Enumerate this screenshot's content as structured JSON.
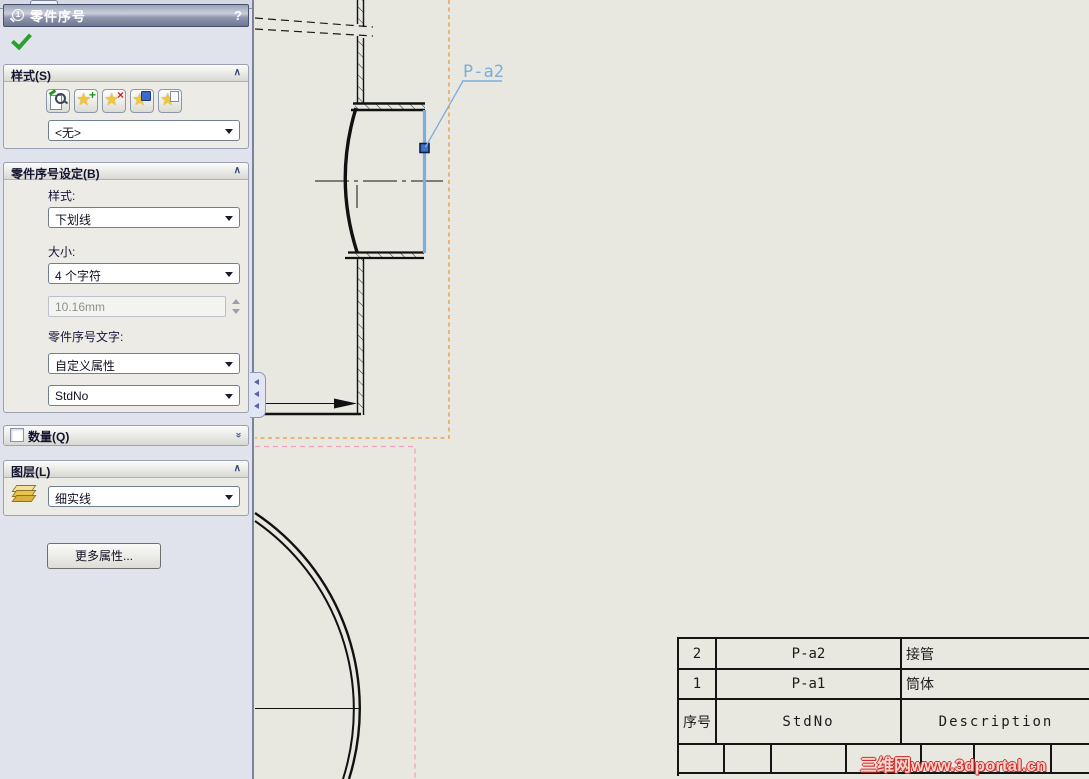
{
  "panel": {
    "title": "零件序号",
    "help_label": "?",
    "style_group": {
      "label": "样式(S)",
      "dropdown_value": "<无>",
      "button_icons": [
        "apply-defaults-icon",
        "add-style-icon",
        "delete-style-icon",
        "save-style-icon",
        "load-style-icon"
      ]
    },
    "settings_group": {
      "label": "零件序号设定(B)",
      "style_label": "样式:",
      "style_value": "下划线",
      "size_label": "大小:",
      "size_value": "4 个字符",
      "custom_size_value": "10.16mm",
      "balloon_text_label": "零件序号文字:",
      "text_source_value": "自定义属性",
      "property_value": "StdNo"
    },
    "quantity_group": {
      "label": "数量(Q)"
    },
    "layer_group": {
      "label": "图层(L)",
      "dropdown_value": "细实线"
    },
    "more_properties_button": "更多属性..."
  },
  "drawing": {
    "balloon_label": "P-a2"
  },
  "bom_table": {
    "rows": [
      {
        "no": "2",
        "std": "P-a2",
        "desc": "接管"
      },
      {
        "no": "1",
        "std": "P-a1",
        "desc": "筒体"
      },
      {
        "no": "序号",
        "std": "StdNo",
        "desc": "Description"
      }
    ]
  },
  "watermark": "三维网www.3dportal.cn",
  "colors": {
    "selection_blue": "#7aade0",
    "sheet_boundary_orange": "#e8973f",
    "view_boundary_pink": "#f2a0bc",
    "watermark_red": "#cc2a2a",
    "ok_green": "#27a327",
    "panel_background": "#e0e3ec",
    "drawing_background": "#e8e8e1"
  }
}
